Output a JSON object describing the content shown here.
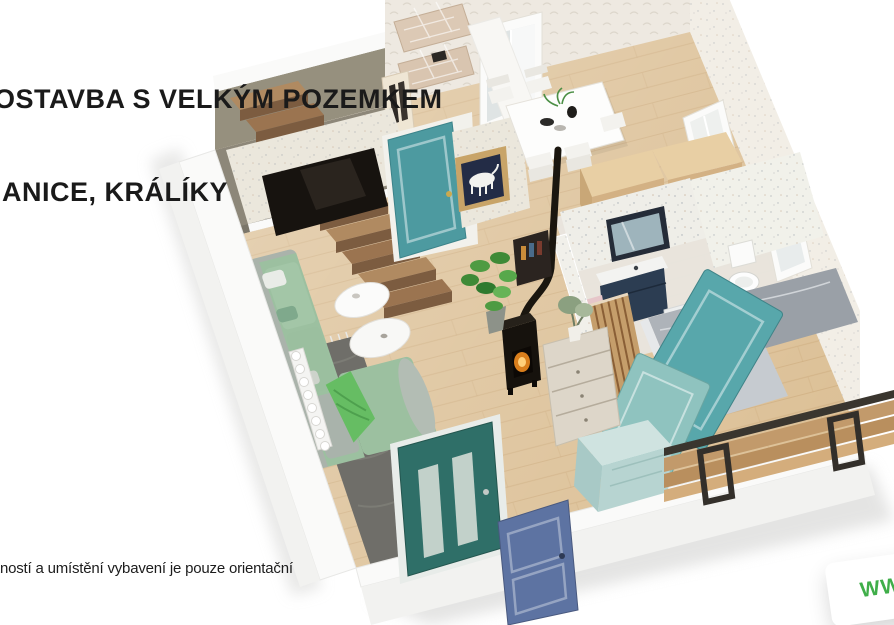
{
  "title": {
    "line1": "OSTAVBA S VELKÝM POZEMKEM",
    "line2": "IANICE, KRÁLÍKY"
  },
  "disclaimer": "tností a umístění vybavení je pouze orientační",
  "watermark": {
    "text": "WW"
  },
  "colors": {
    "title_ink": "#1a1a1a",
    "watermark_green": "#3fae49",
    "wood_floor": "#dcc096",
    "plank_line": "#c8a474",
    "stair_wood_light": "#b08a61",
    "stair_wood_mid": "#9b7450",
    "stair_wood_dark": "#7c5c40",
    "stairwell_gray": "#96907e",
    "landing_gray": "#8d8779",
    "wall_white": "#fafaf9",
    "wall_outer": "#f2f2f0",
    "wallpaper": "#eee9e1",
    "accent_wall": "#ebe7dc",
    "tv_black": "#17130f",
    "teal_door": "#4d9aa0",
    "teal_leaning": "#58a7ab",
    "mint_leaning": "#8fc3bf",
    "entry_door_teal": "#2f6f68",
    "blue_door": "#5d73a2",
    "mint_cabinet_top": "#cfe3e0",
    "mint_cabinet_front": "#b7d4d1",
    "sofa_green": "#9cc0a0",
    "sofa_gray": "#aab3ab",
    "throw_green": "#66bd63",
    "rug_gray": "#6f6e69",
    "kitchen_wood_top": "#e8cfa4",
    "kitchen_wood_front": "#d3b184",
    "slat_wood": "#c59e6b",
    "marble_dark": "#9aa0a7",
    "marble_light": "#c6cbd0",
    "vanity_navy": "#2c3d52",
    "towel_pink": "#e6c6c9",
    "stove_black": "#16120d",
    "fire_glow": "#f08c1f",
    "frame_gold": "#c8a468",
    "painting_navy": "#232c46",
    "bench_wood": "#c29a6b",
    "bench_metal": "#3a362f"
  },
  "scene": {
    "type": "3d-floorplan-render",
    "objects": [
      "staircase",
      "tv-wall",
      "tv-screen",
      "interior-teal-door",
      "horse-painting",
      "dining-table",
      "dining-chairs",
      "window-curtain",
      "kitchen-cabinets",
      "coffee-machine",
      "bathroom-vanity",
      "bathroom-mirror",
      "washing-machine",
      "toilet",
      "marble-shower",
      "wood-slat-partition",
      "leaning-teal-doors",
      "sofa",
      "area-rug",
      "coffee-tables",
      "throw-blanket",
      "radiator",
      "wood-stove",
      "stove-pipe",
      "chest-of-drawers",
      "fiddle-leaf-plant",
      "yucca-plant",
      "entry-glass-door",
      "blue-panel-door",
      "mint-cabinet",
      "outdoor-bench",
      "quilted-benches",
      "wardrobe"
    ]
  }
}
